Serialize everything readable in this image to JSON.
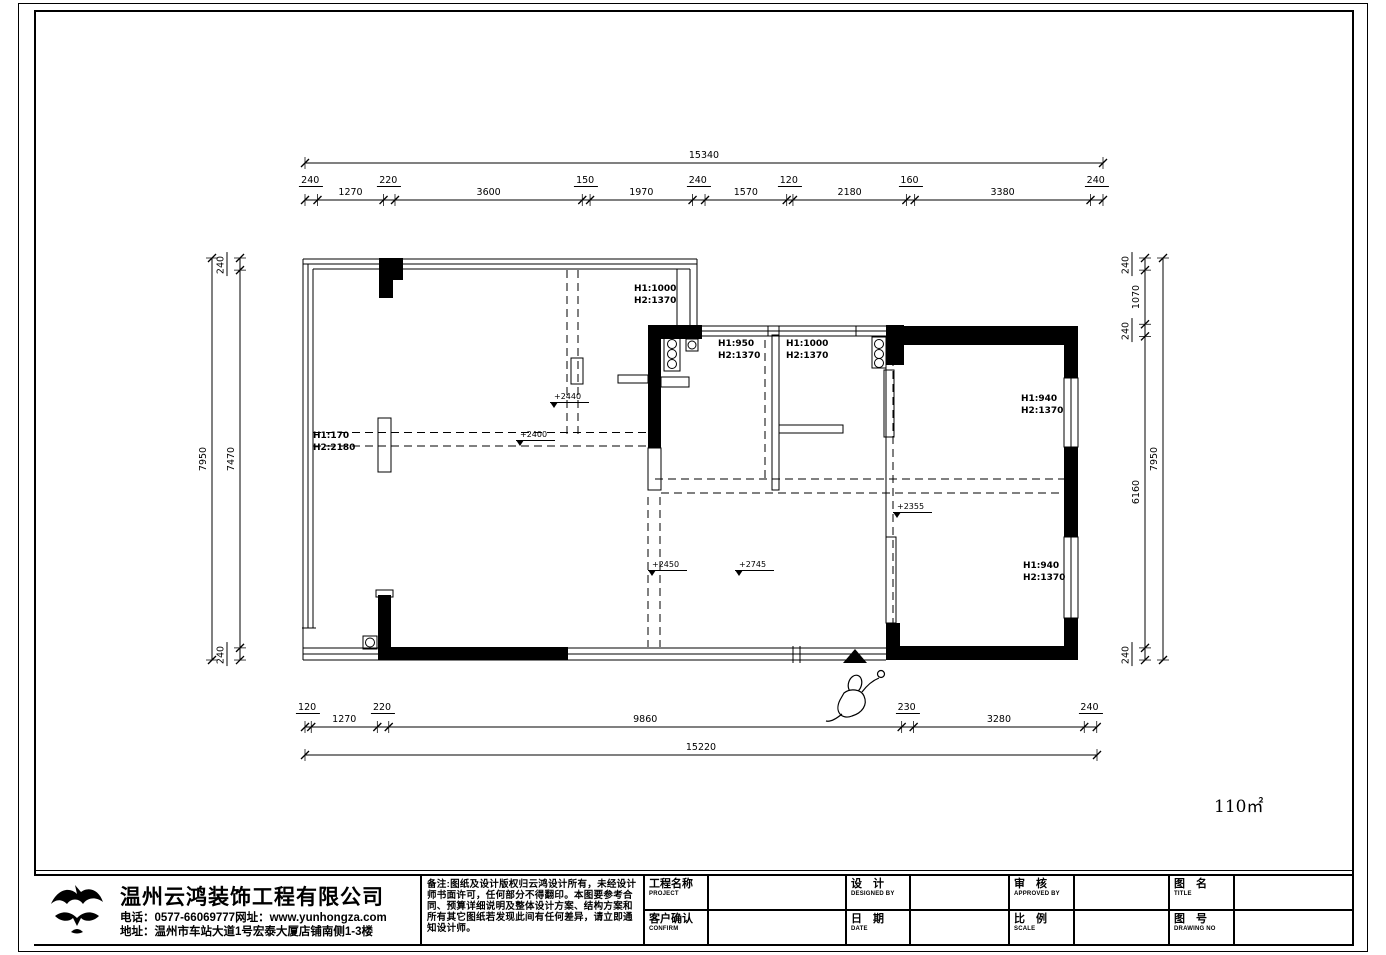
{
  "plan": {
    "area_label": "110㎡",
    "window_labels": [
      {
        "lines": [
          "H1:1000",
          "H2:1370"
        ],
        "x": 634,
        "y": 284
      },
      {
        "lines": [
          "H1:950",
          "H2:1370"
        ],
        "x": 718,
        "y": 339
      },
      {
        "lines": [
          "H1:1000",
          "H2:1370"
        ],
        "x": 786,
        "y": 339
      },
      {
        "lines": [
          "H1:940",
          "H2:1370"
        ],
        "x": 1021,
        "y": 394
      },
      {
        "lines": [
          "H1:940",
          "H2:1370"
        ],
        "x": 1023,
        "y": 561
      },
      {
        "lines": [
          "H1:170",
          "H2:2180"
        ],
        "x": 313,
        "y": 431
      }
    ],
    "level_markers": [
      {
        "label": "+2440",
        "x": 550,
        "y": 392
      },
      {
        "label": "+2400",
        "x": 516,
        "y": 430
      },
      {
        "label": "+2450",
        "x": 648,
        "y": 560
      },
      {
        "label": "+2745",
        "x": 735,
        "y": 560
      },
      {
        "label": "+2355",
        "x": 893,
        "y": 502
      }
    ],
    "dimensions": {
      "top": {
        "overall": "15340",
        "chain": [
          "240",
          "1270",
          "220",
          "3600",
          "150",
          "1970",
          "240",
          "1570",
          "120",
          "2180",
          "160",
          "3380",
          "240"
        ]
      },
      "bottom": {
        "overall": "15220",
        "chain": [
          "120",
          "1270",
          "220",
          "9860",
          "230",
          "3280",
          "240"
        ]
      },
      "left": {
        "overall": "7950",
        "chain": [
          "240",
          "7470",
          "240"
        ]
      },
      "right": {
        "overall": "7950",
        "chain": [
          "240",
          "1070",
          "240",
          "6160",
          "240"
        ]
      }
    }
  },
  "titleblock": {
    "company": {
      "name": "温州云鸿装饰工程有限公司",
      "phone_line": "电话：0577-66069777网址：www.yunhongza.com",
      "address_line": "地址：温州市车站大道1号宏泰大厦店铺南侧1-3楼"
    },
    "notes": "备注:图纸及设计版权归云鸿设计所有，未经设计师书面许可，任何部分不得翻印。本图要参考合同、预算详细说明及整体设计方案、结构方案和所有其它图纸若发现此间有任何差异，请立即通知设计师。",
    "fields": {
      "project_label": "工程名称",
      "project_sub": "PROJECT",
      "confirm_label": "客户确认",
      "confirm_sub": "CONFIRM",
      "design_label": "设　计",
      "design_sub": "DESIGNED BY",
      "date_label": "日　期",
      "date_sub": "DATE",
      "approved_label": "审　核",
      "approved_sub": "APPROVED BY",
      "scale_label": "比　例",
      "scale_sub": "SCALE",
      "title_label": "图　名",
      "title_sub": "TITLE",
      "drawing_label": "图　号",
      "drawing_sub": "DRAWING NO"
    }
  }
}
